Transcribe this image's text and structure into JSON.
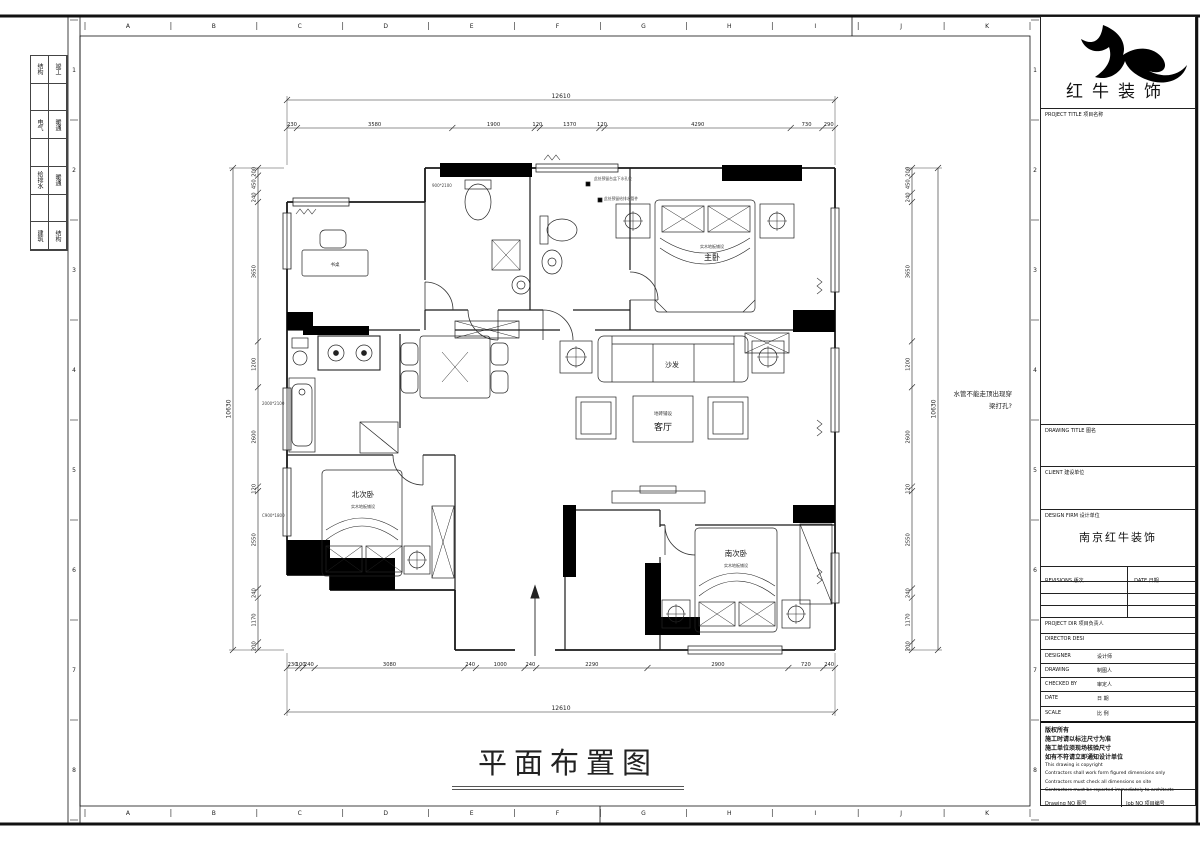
{
  "sheet": {
    "grid_letters": [
      "A",
      "B",
      "C",
      "D",
      "E",
      "F",
      "G",
      "H",
      "I",
      "J",
      "K"
    ],
    "grid_numbers": [
      "1",
      "2",
      "3",
      "4",
      "5",
      "6",
      "7",
      "8"
    ]
  },
  "signoff": {
    "rows": [
      [
        "结构",
        "竣工"
      ],
      [
        "电气",
        "暖通"
      ],
      [
        "给排水",
        "暖通"
      ],
      [
        "建筑",
        "结构"
      ]
    ]
  },
  "titleblock": {
    "brand": "红牛装饰",
    "project_title": "PROJECT TITLE  项目名称",
    "drawing_title": "DRAWING TITLE  图名",
    "client": "CLIENT  建设单位",
    "design_firm": "DESIGN FIRM  设计单位",
    "firm_name": "南京红牛装饰",
    "revisions": "REVISIONS  版次",
    "date_col": "DATE  日期",
    "project_dir": "PROJECT DIR   项目负责人",
    "director": "DIRECTOR DESI",
    "designer_en": "DESIGNER",
    "designer_cn": "设计师",
    "drawing_en": "DRAWING",
    "drawing_cn": "制图人",
    "checked_en": "CHECKED BY",
    "checked_cn": "审定人",
    "date_en": "DATE",
    "date_cn": "日  期",
    "scale_en": "SCALE",
    "scale_cn": "比  例",
    "copyright": [
      "版权所有",
      "施工时请以标注尺寸为准",
      "施工单位须现场核验尺寸",
      "如有不符请立即通知设计单位",
      "This drawing is copyright",
      "Contractors shall work form figured dimensions only",
      "Contractors must check all dimensions on site",
      "Contractors must be reported immediately to architects"
    ],
    "drawing_no": "Drawing NO  图号",
    "job_no": "Job NO  项目编号"
  },
  "plan": {
    "title": "平面布置图",
    "rooms": {
      "master": "主卧",
      "master_floor": "实木地板铺设",
      "north": "北次卧",
      "north_floor": "实木地板铺设",
      "south": "南次卧",
      "south_floor": "实木地板铺设",
      "living": "客厅",
      "living_floor": "地砖铺设",
      "sofa": "沙发",
      "desk": "书桌"
    },
    "note_line1": "水管不能走顶出现穿",
    "note_line2": "梁打孔?",
    "tags": {
      "t1": "900*2100",
      "t2": "2000*2100",
      "t3": "C900*1800"
    },
    "anno1": "此处预留台盆下水孔位",
    "anno2": "此处预留给排水管件"
  },
  "dims": {
    "top_total": [
      "12610"
    ],
    "bottom_total": [
      "12610"
    ],
    "left_total": [
      "10630"
    ],
    "right_total": [
      "10630"
    ],
    "top": [
      "230",
      "3580",
      "1900",
      "120",
      "1370",
      "120",
      "4290",
      "730",
      "290"
    ],
    "bottom": [
      "230",
      "100",
      "240",
      "3080",
      "240",
      "1000",
      "240",
      "2290",
      "2900",
      "720",
      "240"
    ],
    "left": [
      "200",
      "450",
      "240",
      "3650",
      "1200",
      "2600",
      "120",
      "2550",
      "240",
      "1170",
      "200"
    ],
    "right": [
      "200",
      "450",
      "240",
      "3650",
      "1200",
      "2600",
      "120",
      "2550",
      "240",
      "1170",
      "200"
    ]
  }
}
